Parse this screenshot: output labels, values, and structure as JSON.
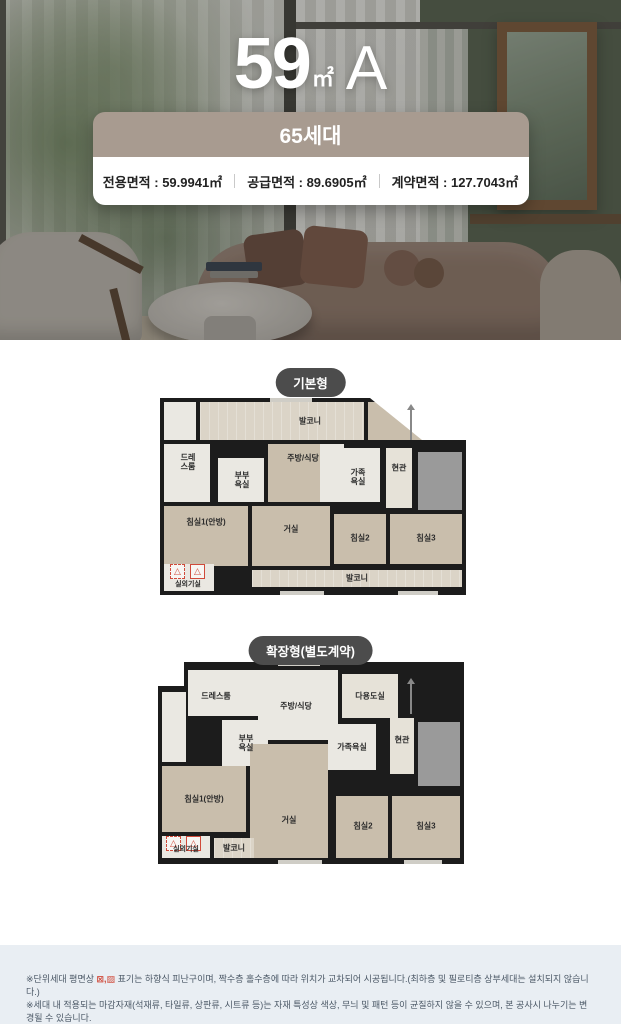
{
  "hero": {
    "title": {
      "number": "59",
      "unit": "㎡",
      "type": "A"
    },
    "badge": "65세대",
    "specs": [
      "전용면적 : 59.9941㎡",
      "공급면적 : 89.6905㎡",
      "계약면적 : 127.7043㎡"
    ]
  },
  "plans": [
    {
      "tag": "기본형",
      "rooms": {
        "balcony_top": "발코니",
        "dress": "드레스룸",
        "master_bath": "부부욕실",
        "kitchen": "주방/식당",
        "family_bath": "가족욕실",
        "entrance": "현관",
        "bed1": "침실1(안방)",
        "living": "거실",
        "bed2": "침실2",
        "bed3": "침실3",
        "balcony_bottom": "발코니",
        "outdoor_unit": "실외기실"
      }
    },
    {
      "tag": "확장형(별도계약)",
      "rooms": {
        "dress": "드레스룸",
        "kitchen": "주방/식당",
        "utility": "다용도실",
        "master_bath": "부부욕실",
        "family_bath": "가족욕실",
        "entrance": "현관",
        "bed1": "침실1(안방)",
        "living": "거실",
        "bed2": "침실2",
        "bed3": "침실3",
        "balcony": "발코니",
        "outdoor_unit": "실외기실"
      }
    }
  ],
  "icons": {
    "escape_hatch": "△"
  },
  "footer": {
    "note1_prefix": "※단위세대 평면상 ",
    "note1_symbols": "⊠,▨",
    "note1_suffix": " 표기는 하향식 피난구이며, 짝수층 홀수층에 따라 위치가 교차되어 시공됩니다.(최하층 및 필로티층 상부세대는 설치되지 않습니다.)",
    "note2": "※세대 내 적용되는 마감자재(석재류, 타일류, 상판류, 시트류 등)는 자재 특성상 색상, 무늬 및 패턴 등이 균질하지 않을 수 있으며, 본 공사시 나누기는 변경될 수 있습니다."
  }
}
